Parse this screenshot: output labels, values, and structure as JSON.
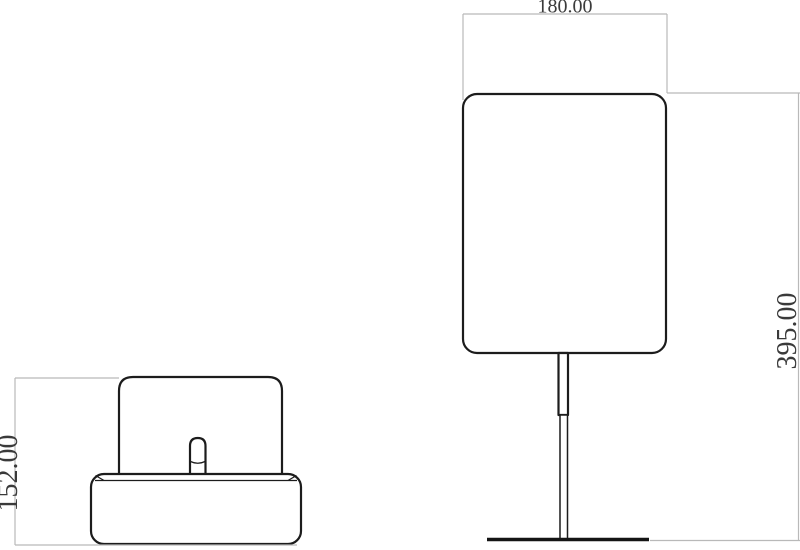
{
  "drawing": {
    "type": "technical-orthographic-drawing",
    "background": "#ffffff",
    "dimensions": {
      "side_height": {
        "value": "152.00",
        "orientation": "vertical"
      },
      "front_width": {
        "value": "180.00",
        "orientation": "horizontal"
      },
      "front_height": {
        "value": "395.00",
        "orientation": "vertical"
      }
    },
    "colors": {
      "object_line": "#1c1c1c",
      "dimension_line": "#b9b9b9",
      "dimension_text": "#3a3a3a",
      "background": "#ffffff"
    }
  }
}
